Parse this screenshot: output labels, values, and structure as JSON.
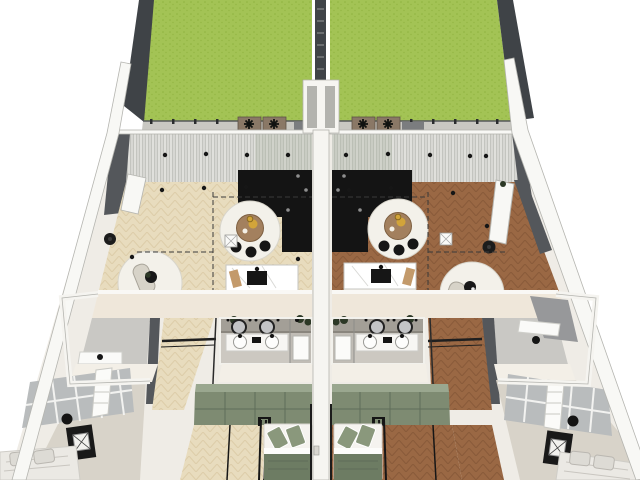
{
  "meta": {
    "title": "Two mirrored apartment units — top-down 3D cutaway floor-plan render",
    "render_style": "SketchUp-style axonometric dollhouse view",
    "units_count": 2
  },
  "palette": {
    "lawn": "#a3c355",
    "lawnDot": "#8fb23f",
    "fence": "#3f4347",
    "paver": "#c9c8c2",
    "planter": "#8a7866",
    "wallWhite": "#f8f8f5",
    "wallEdge": "#b5b5b0",
    "darkWall": "#54575b",
    "cream": "#efe7da",
    "floorBeige": "#e8dcbe",
    "floorBeigeLine": "#d3c099",
    "floorBrown": "#9a6844",
    "floorBrownLine": "#7e5233",
    "curtain": "#d7d7d3",
    "curtainLine": "#c3c4bf",
    "kitchen": "#141414",
    "rug": "#f3f1ea",
    "tableWood": "#a3805e",
    "gold": "#d2a43a",
    "sage": "#7e8b72",
    "sageTop": "#9aa78f",
    "sageDark": "#6d7c63",
    "sageLight": "#8a987c",
    "bathWall": "#a39f97",
    "bathFloor": "#ccc8c1",
    "grayFloor": "#c9c8c4",
    "wardrobeGray": "#b9bcbd",
    "bedWhite": "#ebe9e4",
    "plant": "#2c3826",
    "black": "#161616"
  },
  "scene": {
    "site": {
      "left_garden_surface": "lawn",
      "right_garden_surface": "lawn",
      "boundary": "dark timber fence",
      "party_wall": "central shared wall between the two units",
      "rear_edge": "paver strip with low rail and planter boxes"
    },
    "units": [
      {
        "id": "left-unit",
        "floor_finish": "light oak herringbone",
        "rooms": [
          "garden",
          "living-kitchen-dining",
          "bathroom",
          "utility-room",
          "hallway",
          "rear-bedroom",
          "front-bedroom"
        ],
        "furniture": [
          "black L-shaped kitchen",
          "marble kitchen island",
          "round wooden dining table",
          "round area rugs",
          "curved lounge chairs",
          "double vanity with round mirrors",
          "walk-in shower",
          "sage-green wardrobe wall",
          "double bed with sage bedding",
          "grey panelled wardrobe",
          "double bed with white bedding",
          "black nightstand with lamp"
        ]
      },
      {
        "id": "right-unit",
        "floor_finish": "walnut herringbone",
        "rooms": [
          "garden",
          "living-kitchen-dining",
          "bathroom",
          "home-office",
          "hallway",
          "rear-bedroom",
          "front-bedroom"
        ],
        "furniture": [
          "black L-shaped kitchen",
          "marble kitchen island",
          "round wooden dining table",
          "round area rugs",
          "curved lounge chairs",
          "double vanity with round mirrors",
          "walk-in shower",
          "sage-green wardrobe wall",
          "double bed with sage bedding",
          "grey panelled wardrobe",
          "double bed with white bedding",
          "black nightstand with lamp"
        ]
      }
    ],
    "annotations": [
      "dashed section/zoning lines on living area floors",
      "ceiling spotlights drawn as small black dots",
      "full-width sheer curtains along rear glazing"
    ]
  },
  "labels": {
    "stage": "Architectural floor plan render",
    "left_garden": "Left unit garden (lawn)",
    "right_garden": "Right unit garden (lawn)",
    "center_fence": "Garden dividing fence",
    "party_wall": "Party wall",
    "left_living": "Left unit living / kitchen / dining",
    "right_living": "Right unit living / kitchen / dining",
    "left_kitchen": "Black L-shaped kitchen",
    "right_kitchen": "Black L-shaped kitchen",
    "left_island": "Marble kitchen island",
    "right_island": "Marble kitchen island",
    "left_bath": "Bathroom with double vanity and shower",
    "right_bath": "Bathroom with double vanity and shower",
    "left_bed_rear": "Rear bedroom with sage wardrobe",
    "right_bed_rear": "Rear bedroom with sage wardrobe",
    "left_bed_front": "Front bedroom with grey wardrobe",
    "right_bed_front": "Front bedroom with grey wardrobe"
  }
}
